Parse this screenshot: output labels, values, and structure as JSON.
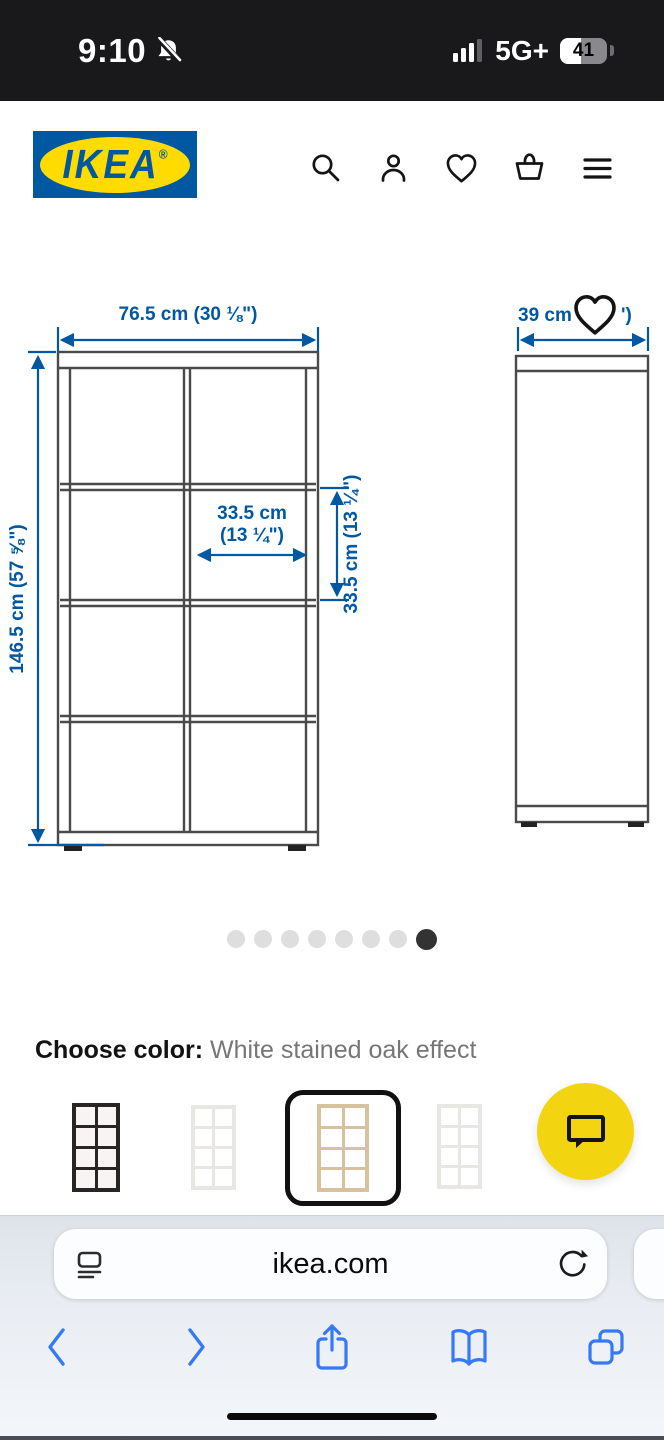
{
  "status_bar": {
    "time": "9:10",
    "network": "5G+",
    "battery_percent": "41"
  },
  "header": {
    "brand": "IKEA",
    "reg_mark": "®",
    "icons": [
      "search-icon",
      "profile-icon",
      "wishlist-icon",
      "cart-icon",
      "menu-icon"
    ]
  },
  "diagram": {
    "front_view": {
      "width_label": "76.5 cm (30 ⅛\")",
      "height_label": "146.5 cm (57 ⅝\")",
      "cell_width_line1": "33.5 cm",
      "cell_width_line2": "(13 ¼\")",
      "cell_height_label": "33.5 cm (13 ¼\")"
    },
    "side_view": {
      "depth_label_left": "39 cm",
      "depth_label_right": "')"
    },
    "accent_color": "#0058a3",
    "line_color": "#4a4a4a"
  },
  "carousel": {
    "count": 8,
    "active_index": 7
  },
  "color_section": {
    "label": "Choose color:",
    "value": "White stained oak effect",
    "options": [
      {
        "name": "black-brown",
        "selected": false
      },
      {
        "name": "white",
        "selected": false
      },
      {
        "name": "white stained oak effect",
        "selected": true
      },
      {
        "name": "white",
        "selected": false
      }
    ]
  },
  "chat": {
    "color": "#F2D510"
  },
  "browser": {
    "url": "ikea.com"
  }
}
